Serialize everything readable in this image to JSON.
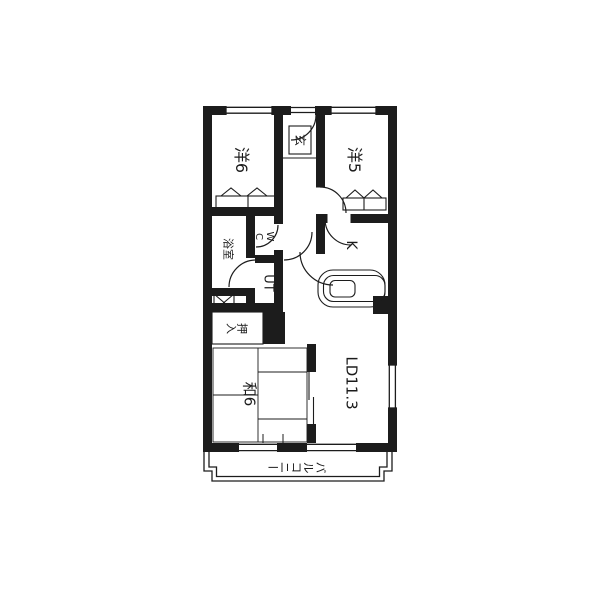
{
  "floorplan": {
    "colors": {
      "line": "#1c1c1c",
      "background": "#ffffff"
    },
    "rooms": {
      "yo6": {
        "label": "洋6"
      },
      "genkan": {
        "label": "玄"
      },
      "yo5": {
        "label": "洋5"
      },
      "bath": {
        "label": "浴室"
      },
      "wc": {
        "label": "WC"
      },
      "ut": {
        "label": "UT"
      },
      "kitchen": {
        "label": "K"
      },
      "oshiire": {
        "label": "押入"
      },
      "wa6": {
        "label": "和6"
      },
      "ld": {
        "label": "LD11.3"
      },
      "balcony": {
        "label": "バルコニー"
      }
    }
  }
}
